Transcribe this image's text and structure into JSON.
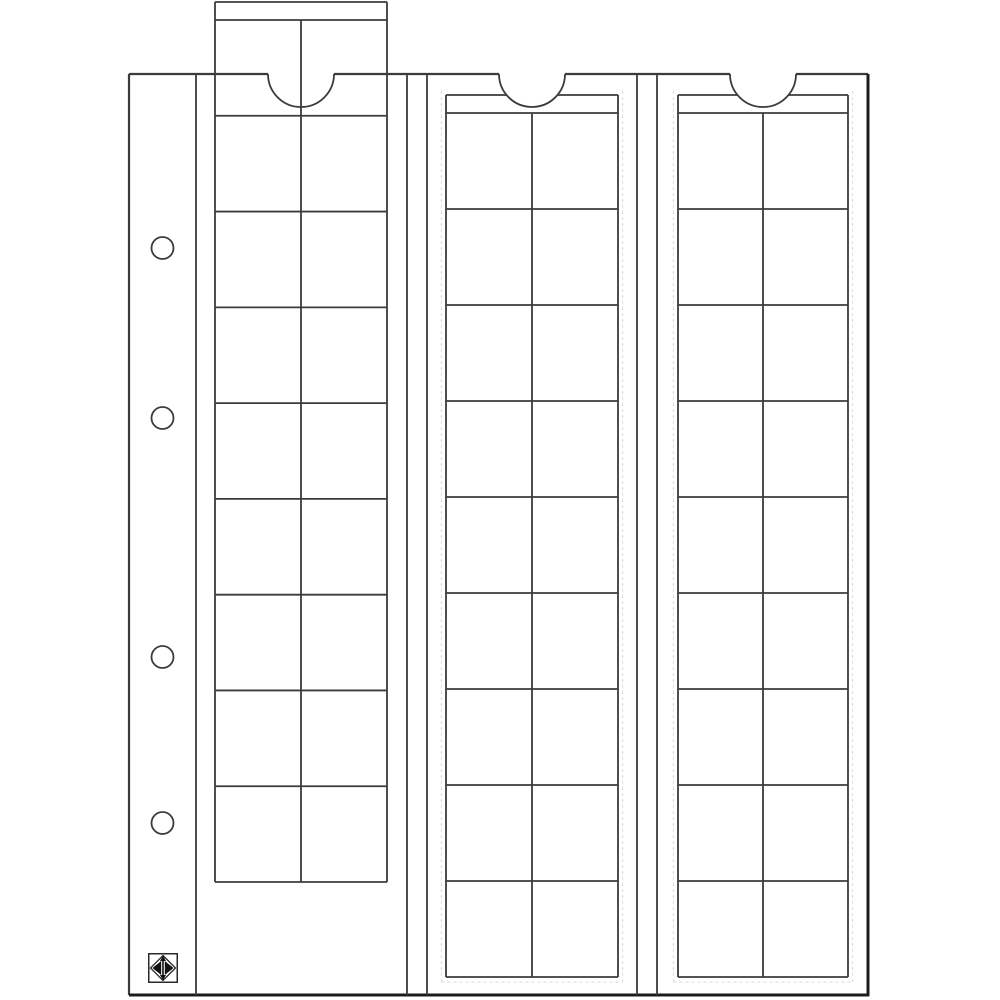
{
  "sheet": {
    "description": "technical-line-drawing-of-coin-album-pocket-sheet",
    "strip_count": 3,
    "pockets_per_strip": 18,
    "pocket_columns_per_strip": 2,
    "pocket_rows_per_strip": 9,
    "binder_hole_count": 4
  },
  "colors": {
    "background": "#ffffff",
    "line": "#3b3b3b",
    "heavy_edge": "#1c1c1c",
    "faint_line": "#e0e0e0",
    "logo_ink": "#111111"
  },
  "drawing": {
    "page": {
      "left": 129,
      "top": 74,
      "right": 868,
      "bottom": 995
    },
    "margin": {
      "divider_x": 196,
      "holes": {
        "cx": 162.5,
        "r": 11,
        "cys": [
          248,
          418,
          657,
          823
        ]
      },
      "logo": {
        "x": 148,
        "y": 953,
        "size": 30
      }
    },
    "channel_verticals": [
      407,
      427,
      637,
      657
    ],
    "strips": [
      {
        "id": "strip-1",
        "left": 215,
        "right": 387,
        "top": 2,
        "header_h": 18,
        "rows": 9,
        "row_h": 95.78,
        "pulled_out": true,
        "faint_outline": false
      },
      {
        "id": "strip-2",
        "left": 446,
        "right": 618,
        "top": 95,
        "header_h": 18,
        "rows": 9,
        "row_h": 96,
        "pulled_out": false,
        "faint_outline": true
      },
      {
        "id": "strip-3",
        "left": 678,
        "right": 848,
        "top": 95,
        "header_h": 18,
        "rows": 9,
        "row_h": 96,
        "pulled_out": false,
        "faint_outline": true
      }
    ],
    "thumb_cutouts": {
      "radius": 33,
      "centers_x": [
        301,
        532,
        763
      ],
      "chord_y": 74
    },
    "stroke": {
      "normal": 1.8,
      "page": 2.2,
      "heavy": 3
    }
  }
}
